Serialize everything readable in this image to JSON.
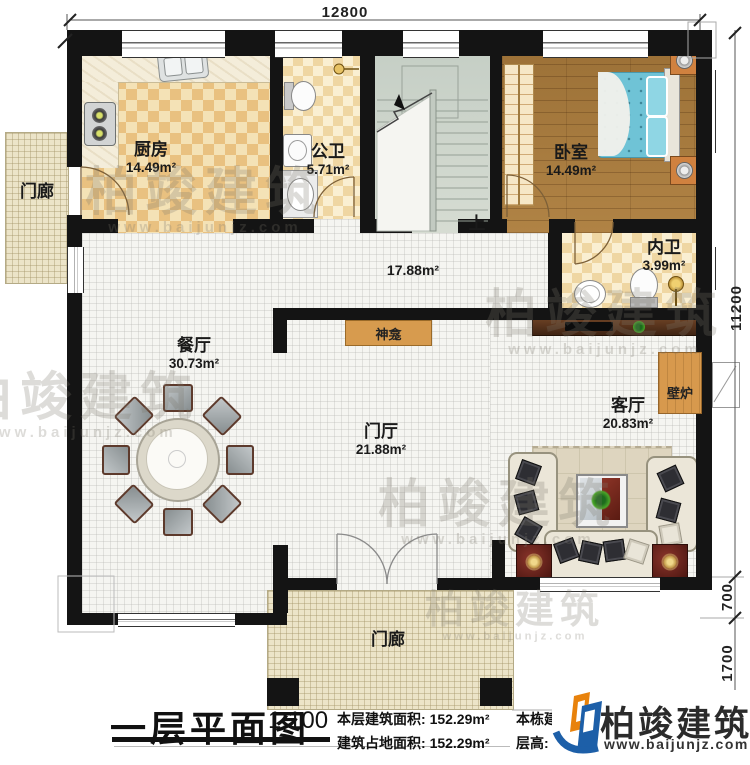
{
  "plan_title": "一层平面图",
  "scale": "1:100",
  "stats": {
    "floor_area_label": "本层建筑面积:",
    "floor_area": "152.29m²",
    "footprint_label": "建筑占地面积:",
    "footprint": "152.29m²",
    "total_area_label": "本栋建筑面积:",
    "total_area": "456.87m²",
    "height_label": "层高:",
    "height": "3.6m"
  },
  "dimensions": {
    "overall_width": "12800",
    "overall_depth": "11200",
    "seg_700": "700",
    "seg_1700": "1700"
  },
  "rooms": {
    "kitchen": {
      "name": "厨房",
      "area": "14.49m²"
    },
    "public_bath": {
      "name": "公卫",
      "area": "5.71m²"
    },
    "bedroom": {
      "name": "卧室",
      "area": "14.49m²"
    },
    "inner_bath": {
      "name": "内卫",
      "area": "3.99m²"
    },
    "hall": {
      "area": "17.88m²"
    },
    "dining": {
      "name": "餐厅",
      "area": "30.73m²"
    },
    "foyer": {
      "name": "门厅",
      "area": "21.88m²"
    },
    "living": {
      "name": "客厅",
      "area": "20.83m²"
    },
    "porch_left": {
      "name": "门廊"
    },
    "porch_bottom": {
      "name": "门廊"
    },
    "shrine": {
      "name": "神龛"
    },
    "fireplace": {
      "name": "壁炉"
    },
    "stairs": {
      "up_label": "上"
    }
  },
  "brand": {
    "name": "柏竣建筑",
    "website": "www.baijunjz.com"
  },
  "watermark": {
    "text": "柏竣建筑",
    "website": "www.baijunjz.com"
  },
  "colors": {
    "wall": "#141414",
    "checker": "#e9c180",
    "wood_floor": "#a97c40",
    "bed_blue": "#6fc3d6",
    "accent_orange": "#d7994d",
    "logo_blue": "#1d5fa8",
    "logo_orange": "#e8820c"
  }
}
